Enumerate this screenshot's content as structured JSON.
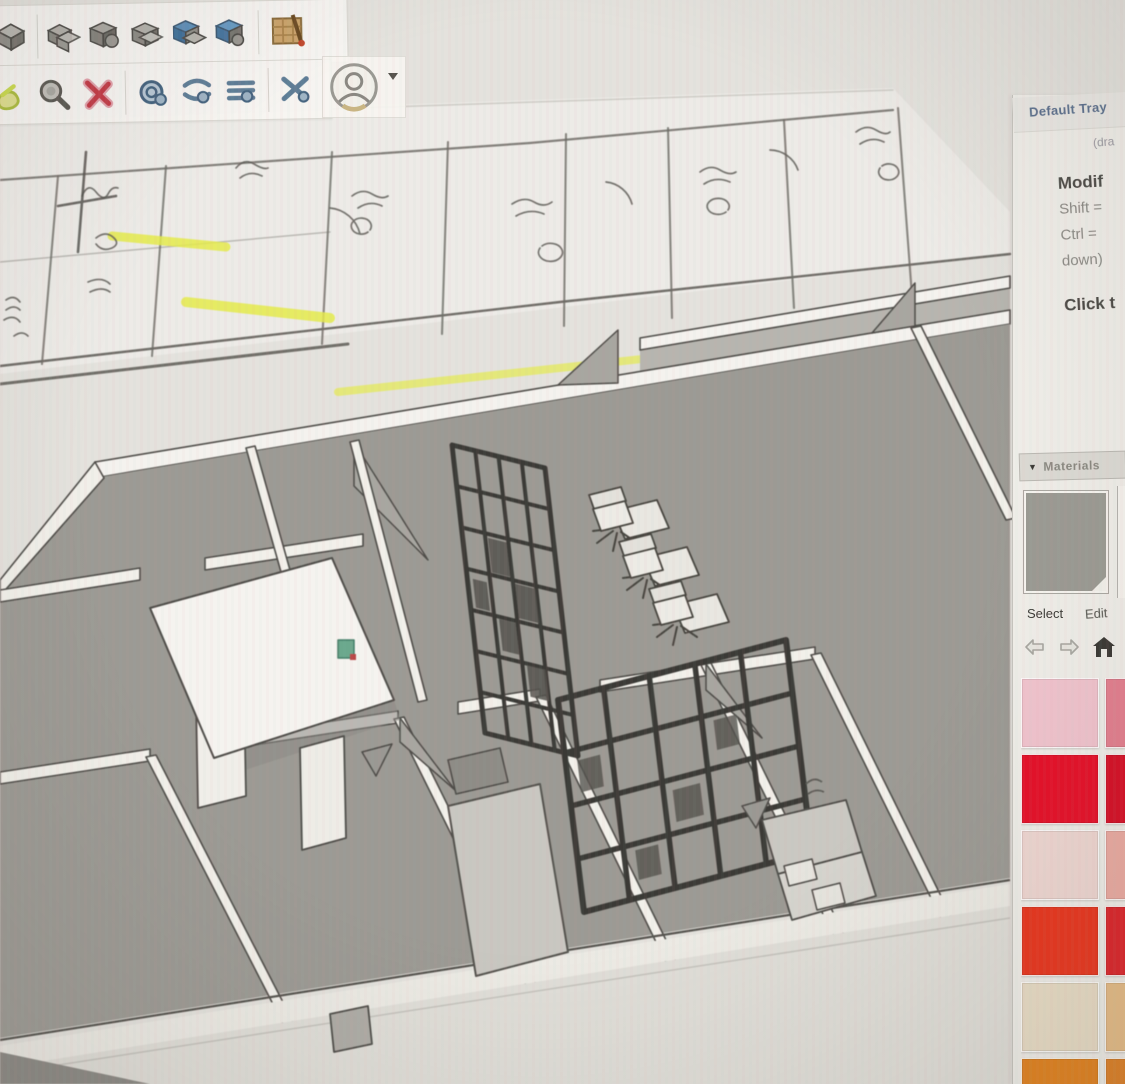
{
  "toolbar": {
    "row1_icons": [
      "cube-tool",
      "outer-shell",
      "union",
      "subtract",
      "trim",
      "intersect",
      "paint-material"
    ],
    "row2_icons": [
      "eraser-tool",
      "zoom-tool",
      "delete-tool",
      "orbit-tool",
      "pan-tool",
      "zoom-extents-tool",
      "previous-view-tool",
      "account",
      "account-caret"
    ]
  },
  "tray": {
    "title": "Default Tray",
    "title_fragment": "(dra",
    "instructor": {
      "heading": "Modif",
      "line1": "Shift =",
      "line2": "Ctrl =",
      "line3": "down)",
      "cta": "Click t"
    },
    "materials": {
      "collapse_caret": "▼",
      "header": "Materials",
      "preview_color": "#9b9a93",
      "select_tab": "Select",
      "edit_tab": "Edit"
    },
    "swatches": {
      "columns_visible": 2,
      "rows": [
        [
          "#f1c4ce",
          "#e37e8e"
        ],
        [
          "#e60e27",
          "#d60d24"
        ],
        [
          "#efd7d2",
          "#ebaaa1"
        ],
        [
          "#e9331b",
          "#dc2127"
        ],
        [
          "#e9ddc6",
          "#e6bc85"
        ],
        [
          "#e2801a",
          "#de7e21"
        ]
      ]
    }
  },
  "scene": {
    "floor_color": "#9c9a94",
    "wall_color": "#f4f2ee",
    "paper_color": "#edebe7",
    "highlighter_color": "#e4ec3e",
    "green_object_color": "#67a98c"
  }
}
